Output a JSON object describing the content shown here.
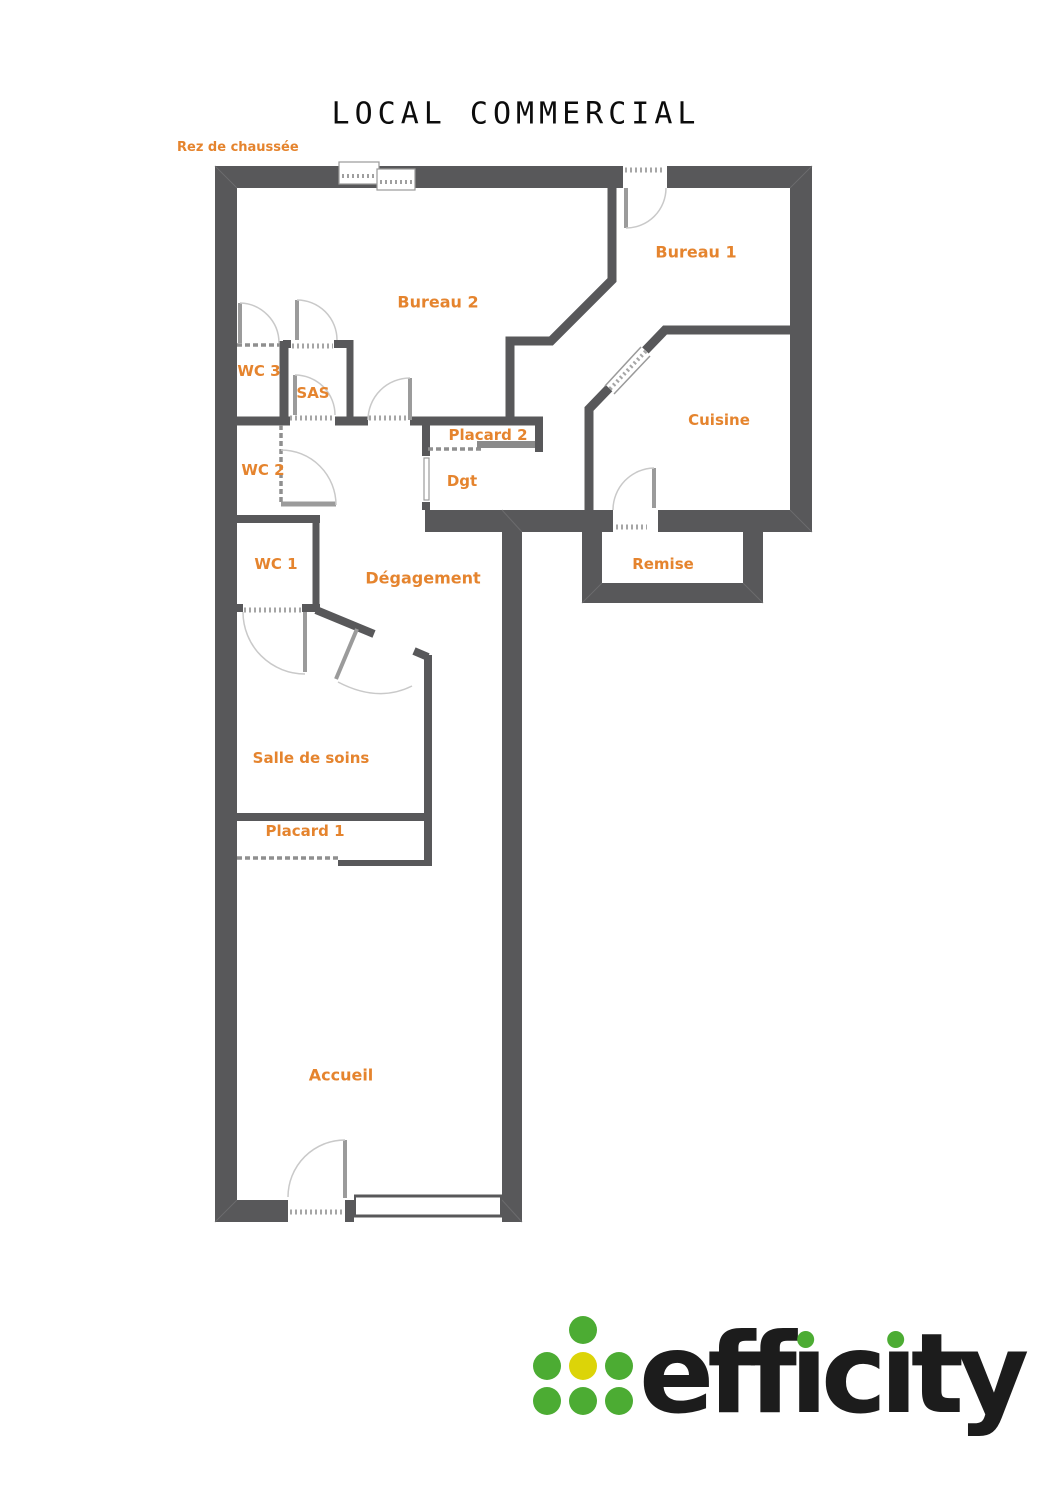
{
  "page": {
    "title": "LOCAL COMMERCIAL",
    "floor_label": "Rez de chaussée"
  },
  "rooms": {
    "bureau2": "Bureau 2",
    "bureau1": "Bureau 1",
    "wc3": "WC 3",
    "sas": "SAS",
    "cuisine": "Cuisine",
    "placard2": "Placard 2",
    "wc2": "WC 2",
    "dgt": "Dgt",
    "wc1": "WC 1",
    "degagement": "Dégagement",
    "remise": "Remise",
    "salle_de_soins": "Salle de soins",
    "placard1": "Placard 1",
    "accueil": "Accueil"
  },
  "logo": {
    "brand": "efficity",
    "part_eff": "eff",
    "part_i1": "ı",
    "part_c": "c",
    "part_i2": "ı",
    "part_ty": "ty"
  },
  "colors": {
    "wall_gray": "#58585A",
    "label_orange": "#E5842E",
    "logo_green": "#4CAC33",
    "logo_yellow": "#DCD408",
    "logo_text_black": "#1C1C1C"
  }
}
